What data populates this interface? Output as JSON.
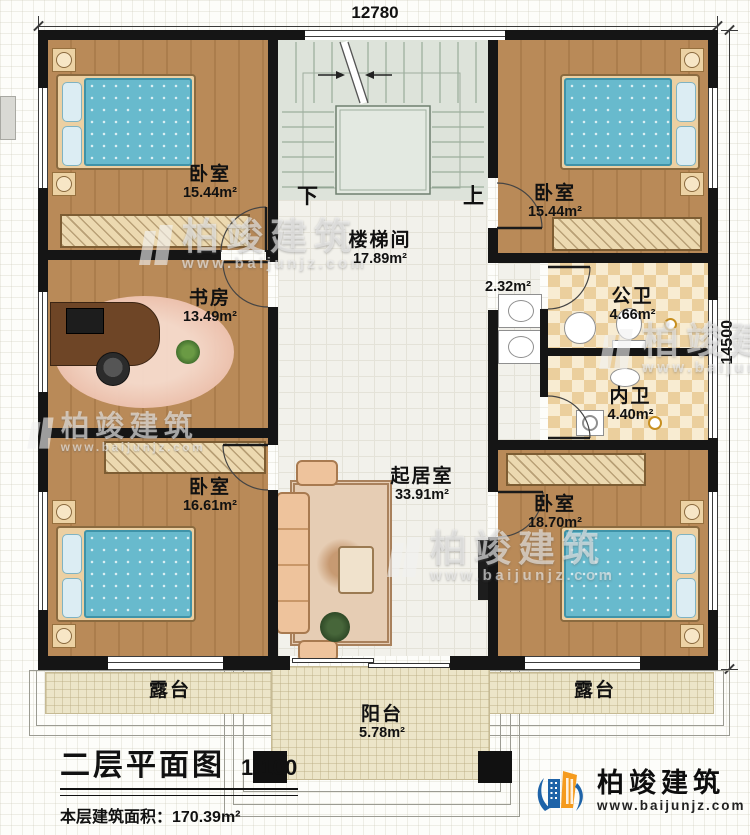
{
  "dimensions": {
    "top": "12780",
    "right": "14500"
  },
  "rooms": {
    "bedroom_tl": {
      "name": "卧室",
      "area": "15.44m²"
    },
    "bedroom_tr": {
      "name": "卧室",
      "area": "15.44m²"
    },
    "stairwell": {
      "name": "楼梯间",
      "area": "17.89m²"
    },
    "study": {
      "name": "书房",
      "area": "13.49m²"
    },
    "hall": {
      "area": "2.32m²"
    },
    "public_bath": {
      "name": "公卫",
      "area": "4.66m²"
    },
    "private_bath": {
      "name": "内卫",
      "area": "4.40m²"
    },
    "bedroom_bl": {
      "name": "卧室",
      "area": "16.61m²"
    },
    "living": {
      "name": "起居室",
      "area": "33.91m²"
    },
    "bedroom_br": {
      "name": "卧室",
      "area": "18.70m²"
    },
    "terrace_left": {
      "name": "露台"
    },
    "terrace_right": {
      "name": "露台"
    },
    "balcony": {
      "name": "阳台",
      "area": "5.78m²"
    }
  },
  "stairs": {
    "down": "下",
    "up": "上"
  },
  "title_block": {
    "title": "二层平面图",
    "scale": "1:100",
    "floor_area": "本层建筑面积：170.39m²",
    "floor_height": "层高：3.4m"
  },
  "brand": {
    "name": "柏竣建筑",
    "url": "www.baijunjz.com"
  },
  "watermark": {
    "name": "柏竣建筑",
    "url": "www.baijunjz.com"
  },
  "colors": {
    "wall": "#151515",
    "wood": "#b5885a",
    "bedding": "#68bacd",
    "tile_tan": "#ecd2a0",
    "brand_blue": "#1e63a8",
    "brand_orange": "#f59b1e"
  }
}
